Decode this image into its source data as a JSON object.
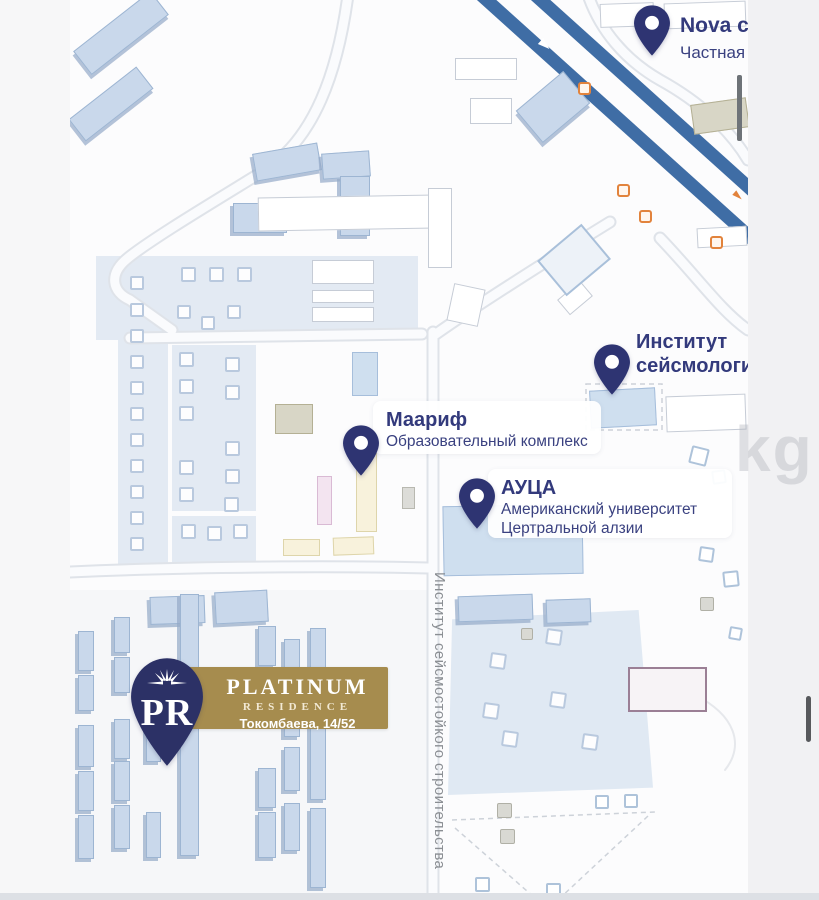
{
  "labels": {
    "nova": {
      "title": "Nova clinic",
      "subtitle": "Частная клиника"
    },
    "seismology": {
      "line1": "Институт",
      "line2": "сейсмологии"
    },
    "maarif": {
      "title": "Маариф",
      "subtitle": "Образовательный комплекс"
    },
    "auca": {
      "title": "АУЦА",
      "line1": "Американский университет",
      "line2": "Цертральной алзии"
    }
  },
  "platinum": {
    "initials": "PR",
    "name": "PLATINUM",
    "tier": "RESIDENCE",
    "address": "Токомбаева, 14/52"
  },
  "street": {
    "name": "Институт сейсмостойкого строительства"
  },
  "watermark": {
    "text": "kg"
  },
  "colors": {
    "pin_navy": "#2e3472",
    "platinum_pin_navy": "#2c3166",
    "banner_gold": "#a68c4e",
    "highway_blue": "#3f6da5",
    "building_blue": "#c9d8eb",
    "label_navy": "#333a7c",
    "bus_stop_orange": "#e2833c"
  }
}
